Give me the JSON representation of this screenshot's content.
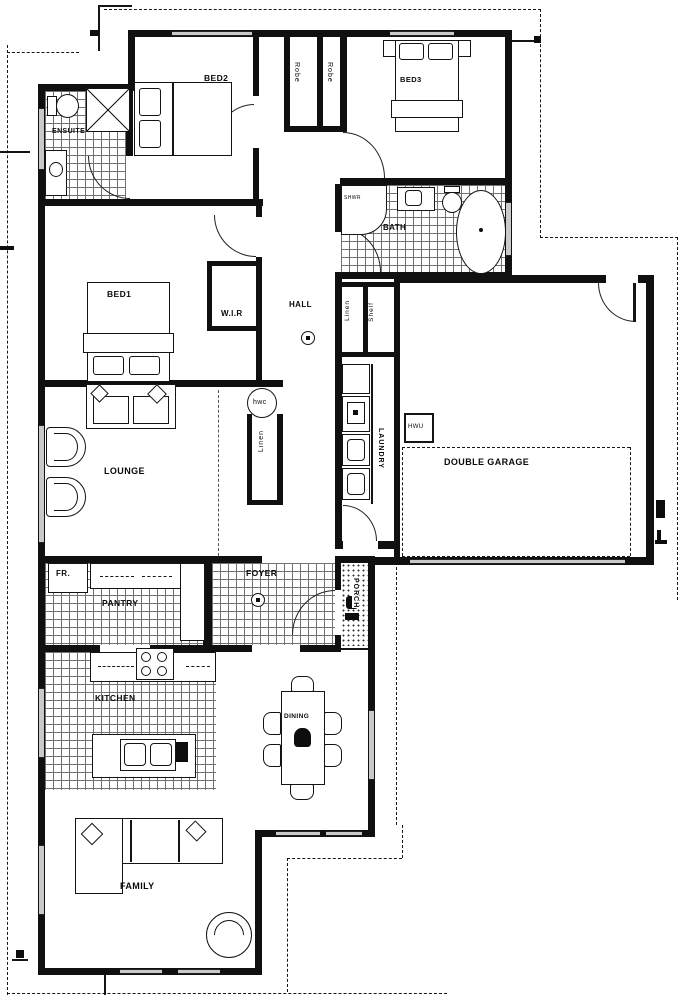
{
  "rooms": {
    "bed1": "BED1",
    "bed2": "BED2",
    "bed3": "BED3",
    "ensuite": "ENSUITE",
    "bath": "BATH",
    "hall": "HALL",
    "wir": "W.I.R",
    "lounge": "LOUNGE",
    "laundry": "LAUNDRY",
    "double_garage": "DOUBLE GARAGE",
    "pantry": "PANTRY",
    "foyer": "FOYER",
    "porch": "PORCH",
    "kitchen": "KITCHEN",
    "dining": "DINING",
    "family": "FAMILY"
  },
  "storage": {
    "robe_bed2": "Robe",
    "robe_bed3": "Robe",
    "linen_hall": "Linen",
    "shelf_hall": "Shelf",
    "linen_lounge": "Linen"
  },
  "fixtures": {
    "hot_water_cylinder": "hwc",
    "fridge": "FR.",
    "hot_water_unit": "HWU",
    "shower": "SHWR"
  },
  "colors": {
    "wall": "#101010",
    "tile_line": "#5a5a5a",
    "window": "#c9c9c9",
    "background": "#ffffff"
  }
}
